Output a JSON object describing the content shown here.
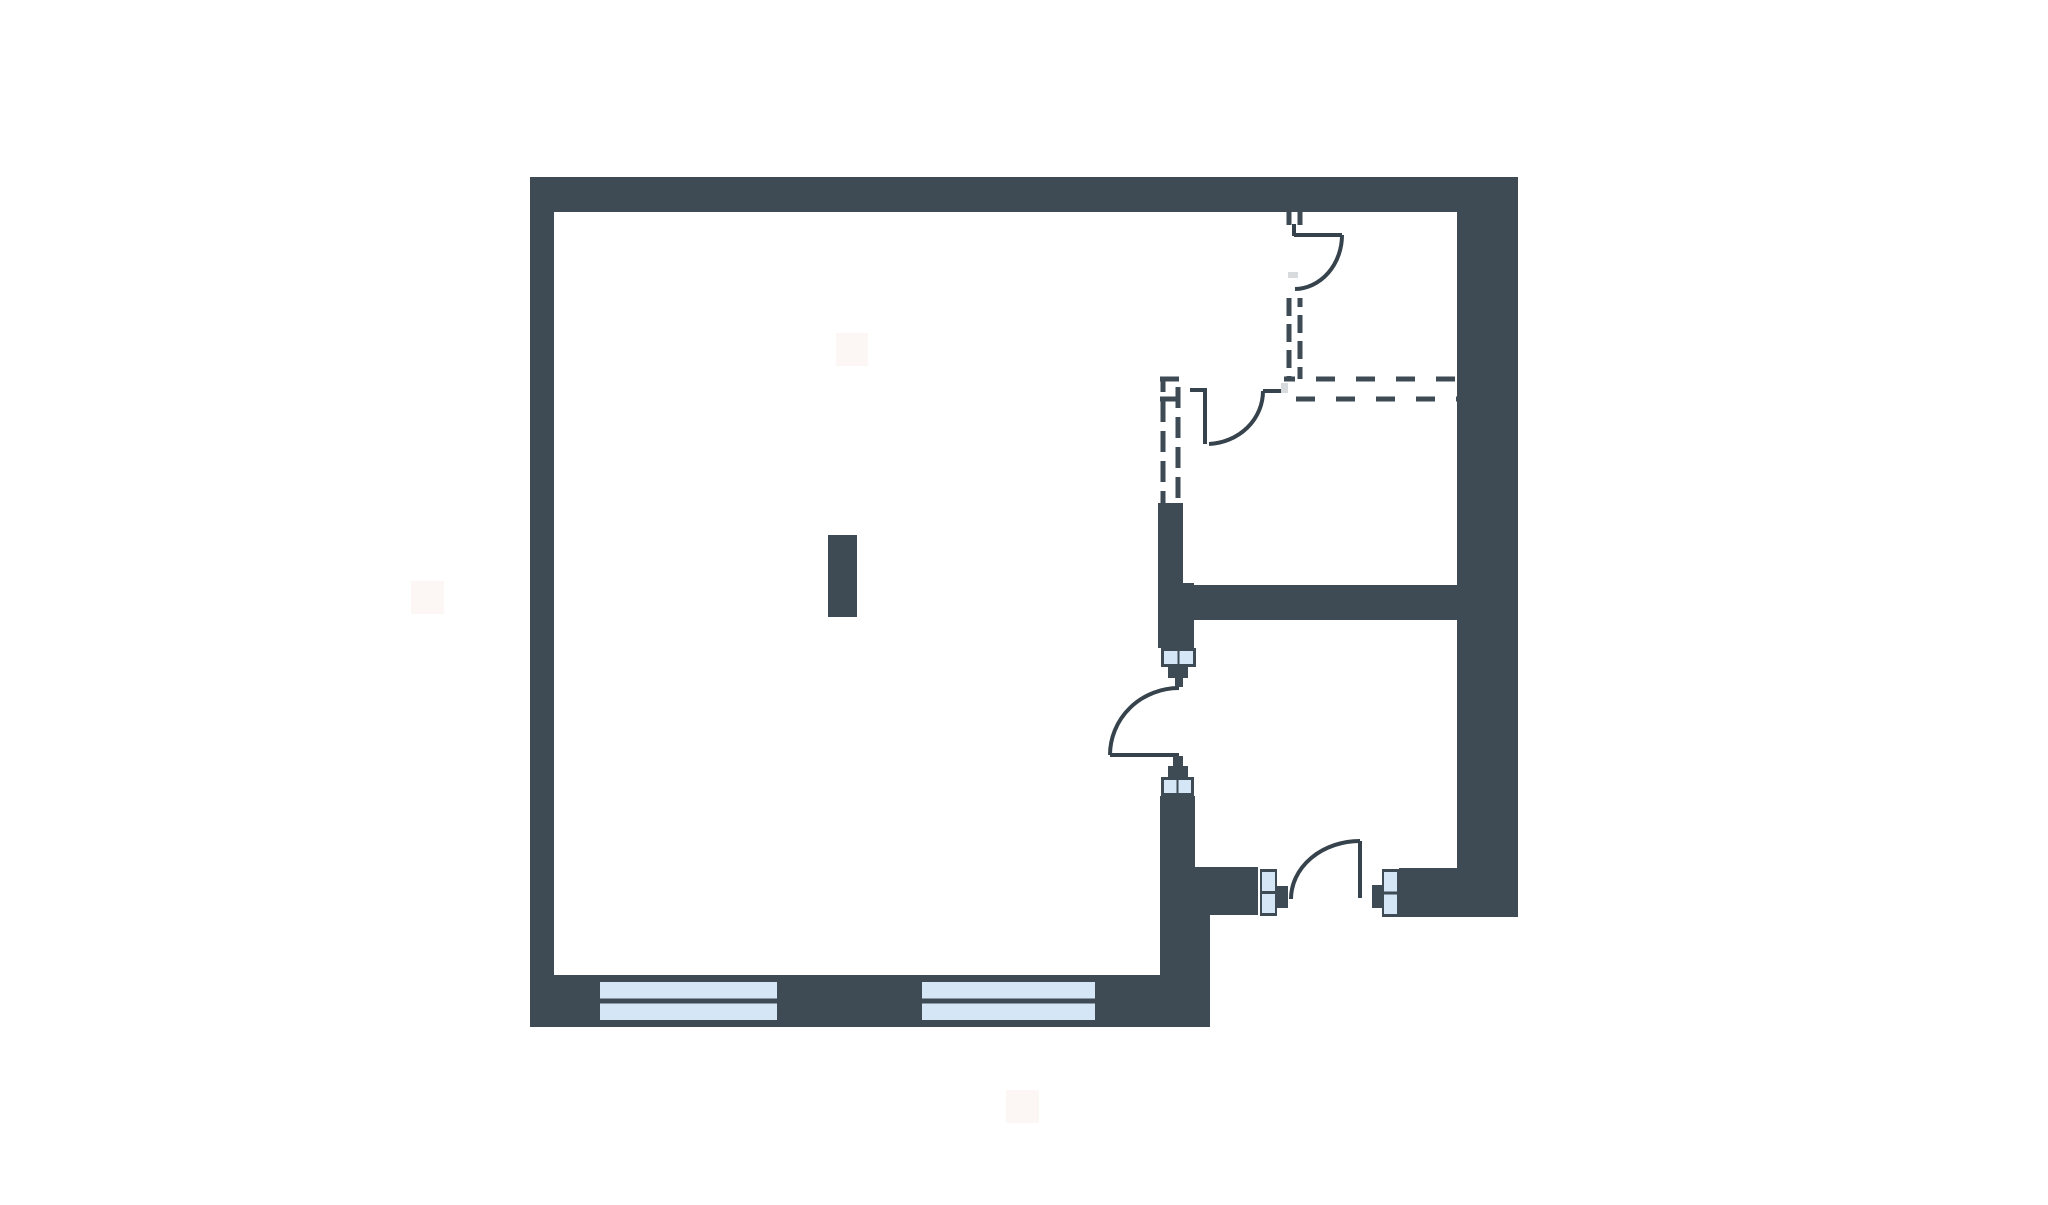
{
  "canvas": {
    "width": 2048,
    "height": 1205,
    "background": "#ffffff"
  },
  "palette": {
    "wall": "#3E4B55",
    "door_stroke": "#36434C",
    "dash_stroke": "#3E4B55",
    "window_pane": "#D5E6F7",
    "window_frame": "#3E4B55",
    "soft_grey": "#D8DBDE",
    "soft_pink": "#FAEDEB"
  },
  "floorplan": {
    "style": {
      "dash_width": 5,
      "door_width": 4,
      "dash_pattern_horizontal": "19 21",
      "dash_pattern_vertical_a": "18 8",
      "dash_pattern_vertical_c": "21 9",
      "stagger_offset": 17
    },
    "solid_walls": [
      {
        "id": "wall-top",
        "r": [
          530,
          177,
          988,
          35
        ]
      },
      {
        "id": "wall-left",
        "r": [
          530,
          177,
          24,
          850
        ]
      },
      {
        "id": "wall-right",
        "r": [
          1457,
          177,
          61,
          740
        ]
      },
      {
        "id": "wall-bottom",
        "r": [
          530,
          975,
          680,
          52
        ]
      },
      {
        "id": "wall-mid-horizontal",
        "r": [
          1158,
          585,
          299,
          35
        ]
      },
      {
        "id": "wall-c-upper",
        "r": [
          1158,
          503,
          25,
          82
        ]
      },
      {
        "id": "wall-c-junction",
        "r": [
          1158,
          583,
          36,
          65
        ]
      },
      {
        "id": "wall-c-mid",
        "r": [
          1160,
          796,
          35,
          71
        ]
      },
      {
        "id": "wall-c-wing",
        "r": [
          1160,
          867,
          98,
          48
        ]
      },
      {
        "id": "wall-c-column",
        "r": [
          1160,
          890,
          50,
          137
        ]
      },
      {
        "id": "wall-entry-right",
        "r": [
          1399,
          868,
          119,
          49
        ]
      }
    ],
    "dashed_walls": [
      {
        "id": "dash-a-left-upper",
        "l": [
          1289,
          212,
          1289,
          225
        ],
        "pattern": "a",
        "offset": 0
      },
      {
        "id": "dash-a-right-upper",
        "l": [
          1300,
          212,
          1300,
          225
        ],
        "pattern": "a",
        "offset": 0
      },
      {
        "id": "dash-a-left-lower",
        "l": [
          1289,
          298,
          1289,
          379
        ],
        "pattern": "a",
        "offset": 0
      },
      {
        "id": "dash-a-right-lower",
        "l": [
          1300,
          298,
          1300,
          379
        ],
        "pattern": "a",
        "offset": 9
      },
      {
        "id": "dash-b-top-left",
        "l": [
          1160,
          379,
          1192,
          379
        ],
        "pattern": "b",
        "offset": 0
      },
      {
        "id": "dash-b-bottom-left",
        "l": [
          1160,
          399,
          1180,
          399
        ],
        "pattern": "b",
        "offset": 0
      },
      {
        "id": "dash-b-top-right",
        "l": [
          1284,
          379,
          1457,
          379
        ],
        "pattern": "b",
        "offset": 8
      },
      {
        "id": "dash-b-bottom-right",
        "l": [
          1284,
          399,
          1457,
          399
        ],
        "pattern": "b",
        "offset": 28
      },
      {
        "id": "dash-c-left",
        "l": [
          1163,
          379,
          1163,
          503
        ],
        "pattern": "c",
        "offset": 8
      },
      {
        "id": "dash-c-right",
        "l": [
          1178,
          379,
          1178,
          503
        ],
        "pattern": "c",
        "offset": 22
      }
    ],
    "doors": [
      {
        "id": "door-upper-right",
        "lines": [
          [
            1294,
            224,
            1294,
            236
          ],
          [
            1294,
            235,
            1342,
            235
          ]
        ],
        "arc": "M 1342 235 A 48 54 0 0 1 1295 289"
      },
      {
        "id": "door-inner-dashed",
        "lines": [
          [
            1190,
            390,
            1206,
            390
          ],
          [
            1205,
            388,
            1205,
            444
          ],
          [
            1263,
            391,
            1281,
            391
          ]
        ],
        "arc": "M 1209 444 A 57 53 0 0 0 1263 391"
      },
      {
        "id": "door-living",
        "lines": [
          [
            1110,
            755,
            1179,
            755
          ]
        ],
        "arc": "M 1110 755 A 69 67 0 0 1 1179 688"
      },
      {
        "id": "door-entry",
        "lines": [
          [
            1360,
            841,
            1360,
            898
          ]
        ],
        "arc": "M 1291 899 A 69 58 0 0 1 1360 841"
      }
    ],
    "windows": [
      {
        "id": "window-bottom-left",
        "r": [
          595,
          975,
          187,
          52
        ],
        "divider": "horizontal",
        "inset": [
          5,
          7,
          5
        ]
      },
      {
        "id": "window-bottom-right",
        "r": [
          917,
          975,
          183,
          52
        ],
        "divider": "horizontal",
        "inset": [
          5,
          7,
          5
        ]
      },
      {
        "id": "jamb-window-upper",
        "r": [
          1161,
          648,
          35,
          19
        ],
        "divider": "vertical",
        "inset": [
          3,
          3,
          2
        ]
      },
      {
        "id": "jamb-window-lower",
        "r": [
          1161,
          777,
          33,
          19
        ],
        "divider": "vertical",
        "inset": [
          3,
          3,
          2
        ]
      },
      {
        "id": "jamb-window-entry-left",
        "r": [
          1260,
          869,
          17,
          47
        ],
        "divider": "horizontal",
        "inset": [
          2,
          3,
          3
        ]
      },
      {
        "id": "jamb-window-entry-right",
        "r": [
          1382,
          869,
          17,
          48
        ],
        "divider": "horizontal",
        "inset": [
          2,
          3,
          3
        ]
      }
    ],
    "stubs": [
      {
        "id": "stub-upper-door-block",
        "r": [
          1168,
          667,
          20,
          11
        ]
      },
      {
        "id": "stub-upper-door-small",
        "r": [
          1175,
          678,
          8,
          9
        ]
      },
      {
        "id": "stub-lower-door-small",
        "r": [
          1173,
          756,
          10,
          10
        ]
      },
      {
        "id": "stub-lower-door-block",
        "r": [
          1168,
          766,
          20,
          11
        ]
      },
      {
        "id": "stub-entry-left",
        "r": [
          1277,
          886,
          11,
          22
        ]
      },
      {
        "id": "stub-entry-right",
        "r": [
          1372,
          885,
          10,
          23
        ]
      }
    ],
    "grey_markers": [
      {
        "id": "marker-door-upper",
        "r": [
          1288,
          272,
          10,
          6
        ]
      },
      {
        "id": "marker-door-inner",
        "r": [
          1281,
          383,
          7,
          10
        ]
      }
    ],
    "pillar": {
      "id": "pillar",
      "r": [
        828,
        535,
        29,
        82
      ]
    },
    "artifacts": [
      {
        "id": "artifact-top",
        "r": [
          836,
          333,
          32,
          33
        ]
      },
      {
        "id": "artifact-left",
        "r": [
          411,
          581,
          33,
          33
        ]
      },
      {
        "id": "artifact-bottom",
        "r": [
          1006,
          1090,
          33,
          33
        ]
      }
    ]
  }
}
